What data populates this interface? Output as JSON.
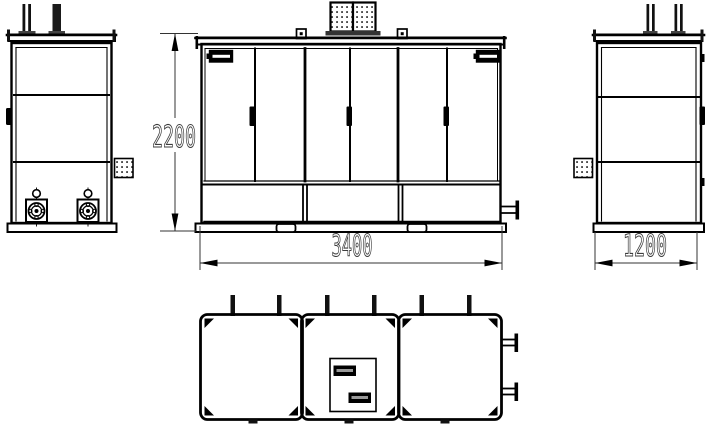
{
  "drawing": {
    "type": "engineering-orthographic-drawing",
    "dimensions": {
      "height_mm": "2200",
      "width_mm": "3400",
      "depth_mm": "1200"
    },
    "views": {
      "left": "left-side-view",
      "front": "front-view",
      "right": "right-side-view",
      "top": "top-plan-view"
    },
    "colors": {
      "line": "#000000",
      "background": "#ffffff",
      "dimension_text": "#3d3d3d",
      "dimension_line": "#333333"
    }
  }
}
